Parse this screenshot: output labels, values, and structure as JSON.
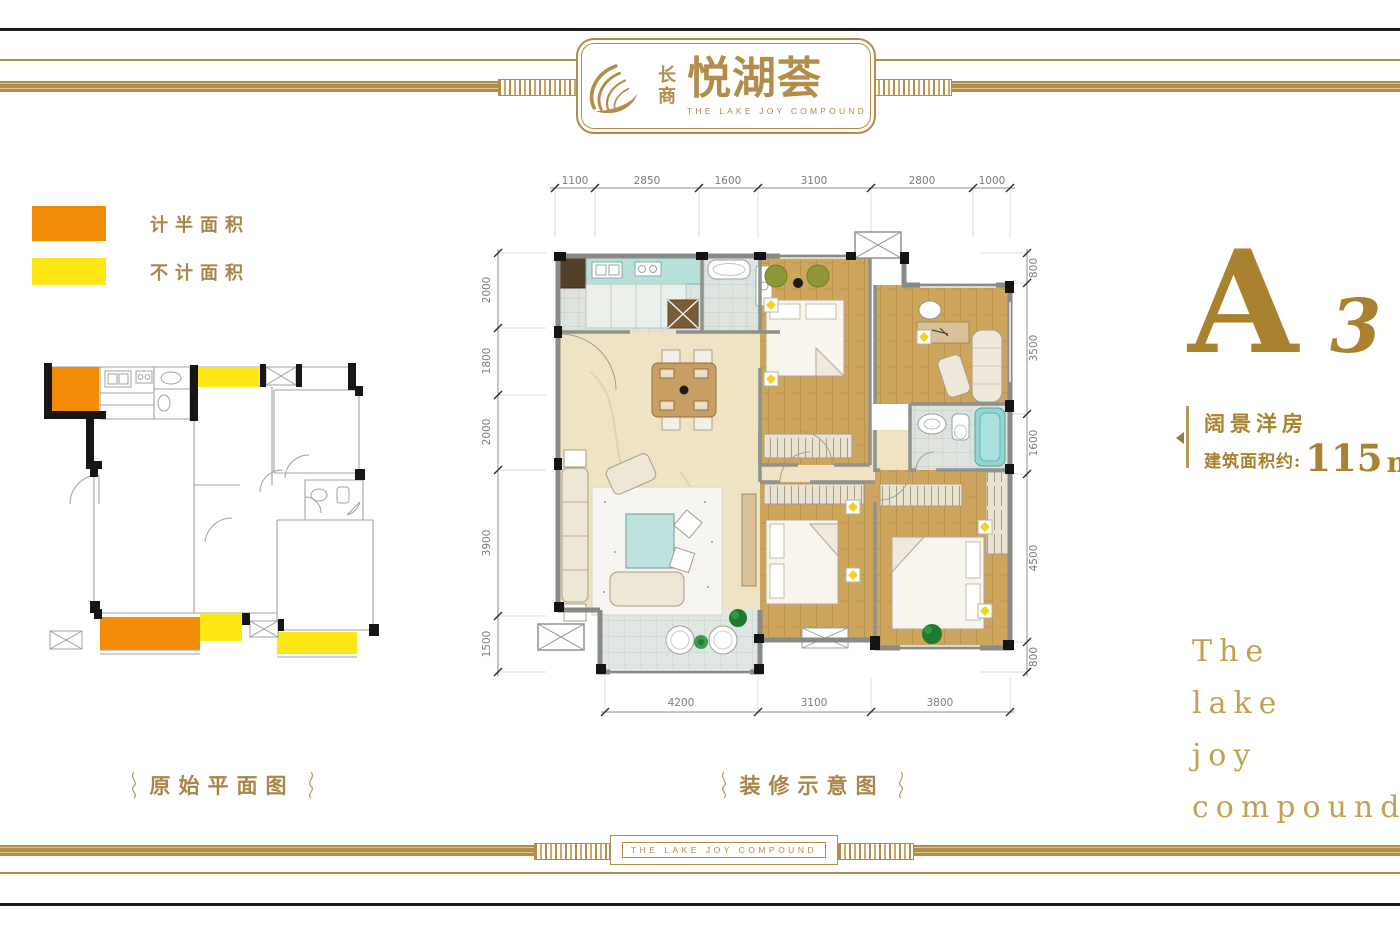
{
  "brand": {
    "name_vertical": "长商",
    "name_main": "悦湖荟",
    "name_en": "THE LAKE JOY COMPOUND"
  },
  "legend": {
    "items": [
      {
        "label": "计半面积",
        "color": "#f28b06"
      },
      {
        "label": "不计面积",
        "color": "#ffe716"
      }
    ]
  },
  "captions": {
    "original_plan": "原始平面图",
    "decorated_plan": "装修示意图"
  },
  "dimensions": {
    "top": [
      "1100",
      "2850",
      "1600",
      "3100",
      "2800",
      "1000"
    ],
    "left": [
      "2000",
      "1800",
      "2000",
      "3900",
      "1500"
    ],
    "right": [
      "800",
      "3500",
      "1600",
      "4500",
      "800"
    ],
    "bottom": [
      "4200",
      "3100",
      "3800"
    ]
  },
  "unit": {
    "letter": "A",
    "number": "3",
    "type": "阔景洋房",
    "area_label": "建筑面积约:",
    "area_value": "115",
    "area_unit": "m",
    "area_exponent": "2"
  },
  "tagline": {
    "lines": [
      "The",
      "lake",
      "joy",
      "compound"
    ]
  },
  "footer": {
    "band_text": "THE LAKE JOY COMPOUND"
  },
  "colors": {
    "gold": "#b28c48",
    "deep_gold": "#a9812f",
    "caption_gold": "#a9854a",
    "tagline_gold": "#c2a14f",
    "legend_orange": "#f28b06",
    "legend_yellow": "#ffe716"
  }
}
